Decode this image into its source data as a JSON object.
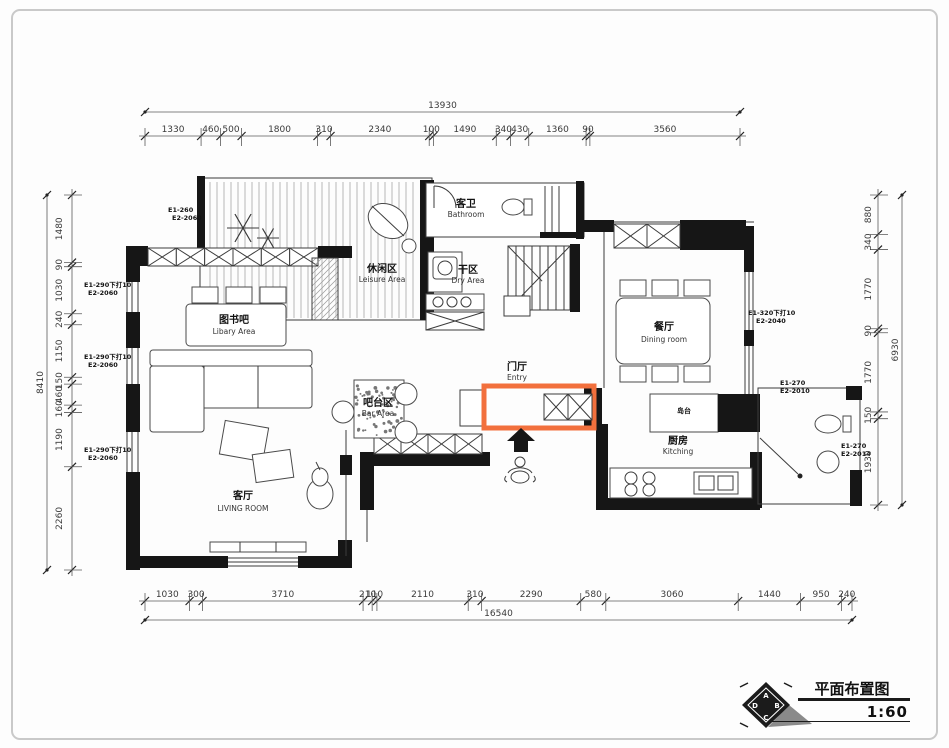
{
  "title_block": {
    "title": "平面布置图",
    "scale": "1:60"
  },
  "logo": {
    "letters": {
      "top": "A",
      "right": "B",
      "bottom": "C",
      "left": "D"
    }
  },
  "dimensions": {
    "top": {
      "total": "13930",
      "segments": [
        1330,
        460,
        500,
        1800,
        310,
        2340,
        100,
        1490,
        340,
        430,
        1360,
        90,
        3560
      ]
    },
    "bottom": {
      "total": "16540",
      "segments": [
        1030,
        300,
        3710,
        210,
        110,
        2110,
        310,
        2290,
        580,
        3060,
        1440,
        950,
        240
      ]
    },
    "left": {
      "total": "8410",
      "segments": [
        1480,
        90,
        1030,
        240,
        1150,
        150,
        460,
        160,
        1190,
        2260
      ]
    },
    "right": {
      "total": "6930",
      "segments": [
        880,
        340,
        1770,
        90,
        1770,
        150,
        1930
      ]
    }
  },
  "rooms": [
    {
      "id": "bathroom",
      "zh": "客卫",
      "en": "Bathroom"
    },
    {
      "id": "leisure",
      "zh": "休闲区",
      "en": "Leisure Area"
    },
    {
      "id": "dry",
      "zh": "干区",
      "en": "Dry Area"
    },
    {
      "id": "library",
      "zh": "图书吧",
      "en": "Libary Area"
    },
    {
      "id": "dining",
      "zh": "餐厅",
      "en": "Dining room"
    },
    {
      "id": "entry",
      "zh": "门厅",
      "en": "Entry"
    },
    {
      "id": "bar",
      "zh": "吧台区",
      "en": "Bar Area"
    },
    {
      "id": "living",
      "zh": "客厅",
      "en": "LIVING ROOM"
    },
    {
      "id": "kitchen",
      "zh": "厨房",
      "en": "Kitching"
    },
    {
      "id": "island",
      "zh": "岛台",
      "en": ""
    }
  ],
  "annotations": [
    {
      "lines": [
        "E1-260",
        "E2-2060"
      ]
    },
    {
      "lines": [
        "E1-290下打10",
        "E2-2060"
      ]
    },
    {
      "lines": [
        "E1-290下打10",
        "E2-2060"
      ]
    },
    {
      "lines": [
        "E1-290下打10",
        "E2-2060"
      ]
    },
    {
      "lines": [
        "E1-320下打10",
        "E2-2040"
      ]
    },
    {
      "lines": [
        "E1-270",
        "E2-2010"
      ]
    },
    {
      "lines": [
        "E1-270",
        "E2-2014"
      ]
    }
  ],
  "colors": {
    "highlight": "#f2703d",
    "wall": "#161616"
  }
}
